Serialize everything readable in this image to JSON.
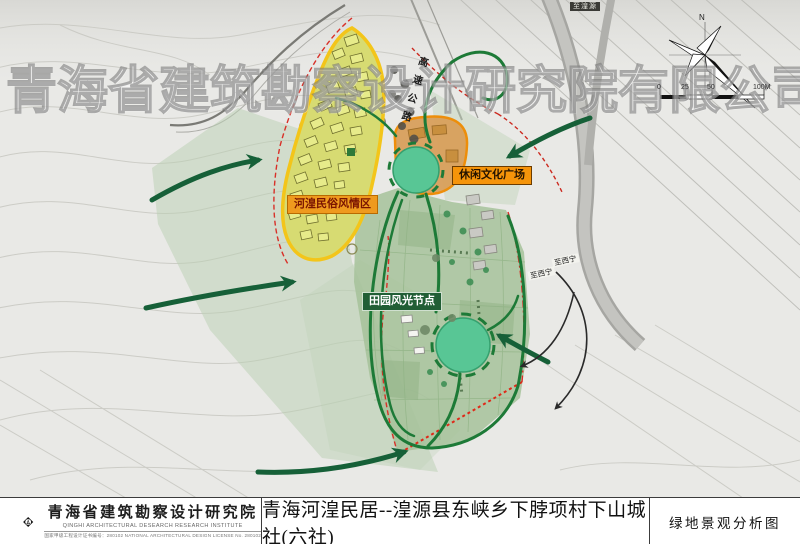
{
  "watermark": {
    "text": "青海省建筑勘察设计研究院有限公司"
  },
  "map": {
    "labels": {
      "folk_zone": "河湟民俗风情区",
      "leisure_plaza": "休闲文化广场",
      "pastoral_node": "田园风光节点",
      "highway": "高速公路",
      "road_top": "至湟源",
      "to_xining_a": "至西宁",
      "to_xining_b": "至西宁"
    },
    "compass": {
      "north": "N"
    },
    "scale_bar": {
      "ticks": [
        "0",
        "25",
        "50",
        "100M"
      ]
    }
  },
  "title_block": {
    "institute": {
      "name_cn": "青海省建筑勘察设计研究院",
      "name_en": "QINGHI ARCHITECTURAL DESEARCH RESEARCH INSTITUTE",
      "license": "国家甲级工程设计证书编号：280102    NATIONAL ARCHITECTURAL DESIGN LICENSE No. 280102"
    },
    "project_title": "青海河湟民居--湟源县东峡乡下脖项村下山城社(六社)",
    "drawing_title": "绿地景观分析图"
  },
  "legend_colors": {
    "zone_yellow_fill": "#d7db72",
    "zone_yellow_border": "#f3c51a",
    "plaza_orange": "#ef8a00",
    "node_teal": "#58c695",
    "path_green": "#1d7a37",
    "boundary_red": "#d83028"
  }
}
